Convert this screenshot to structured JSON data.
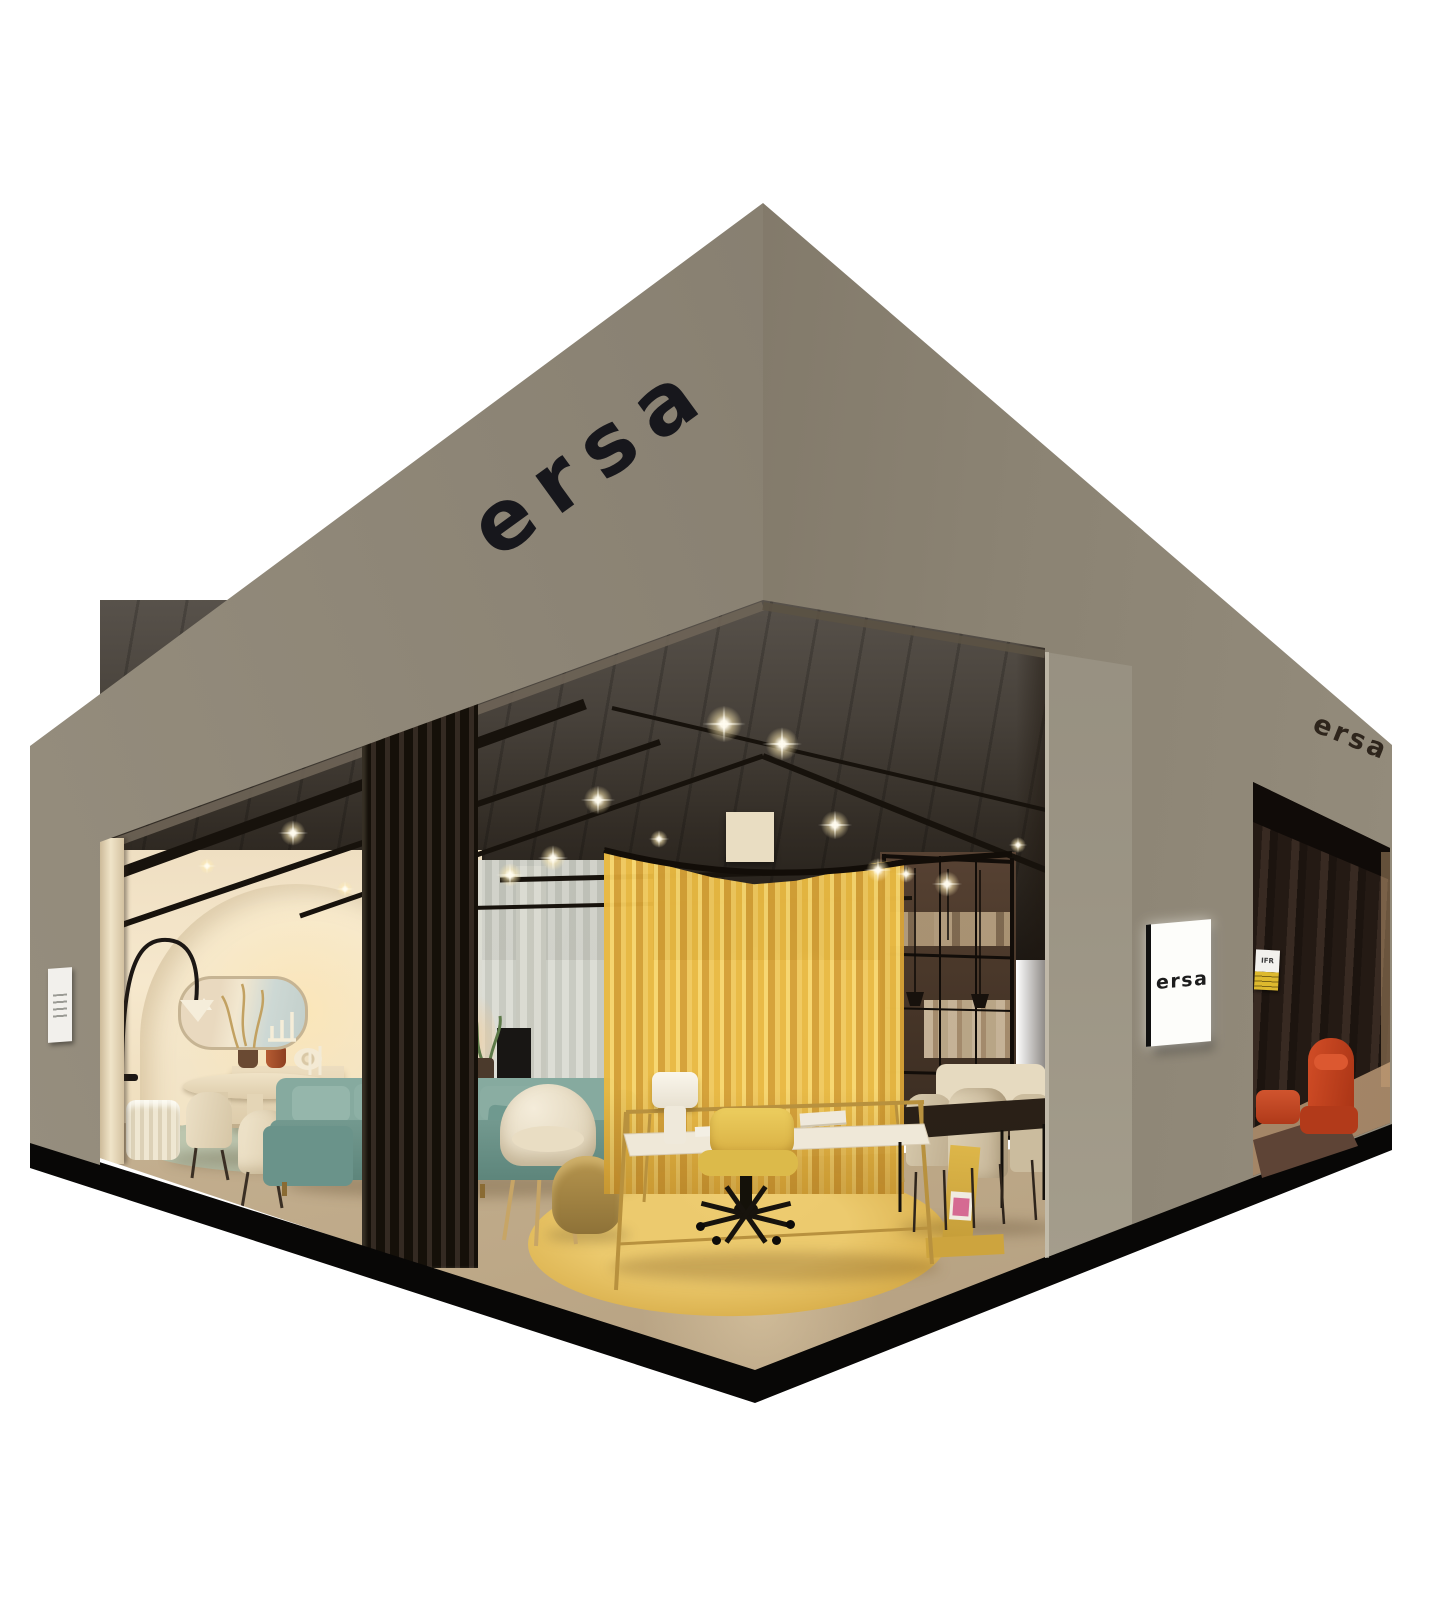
{
  "branding": {
    "fascia_logo": "ersa",
    "side_fascia_logo": "ersa",
    "pillar_sign_logo": "ersa",
    "entrance_badge": "IFR"
  },
  "palette": {
    "background": "#ffffff",
    "exterior_left_wall": "#8b8374",
    "exterior_right_wall": "#7e7566",
    "front_pillar": "#9d9787",
    "platform_base": "#080706",
    "interior_wall_cream": "#f5e7cd",
    "ceiling": "#3c362f",
    "floor": "#c8b497",
    "curtain_yellow": "#ecc257",
    "rug_yellow": "#dfb557",
    "rug_sage": "#b6c1aa",
    "sofa_teal": "#7da399",
    "armchair_red": "#c64120",
    "doorway_curtain": "#2a1f19",
    "desk_brass": "#b8913e",
    "office_chair_yellow": "#e2c155"
  }
}
